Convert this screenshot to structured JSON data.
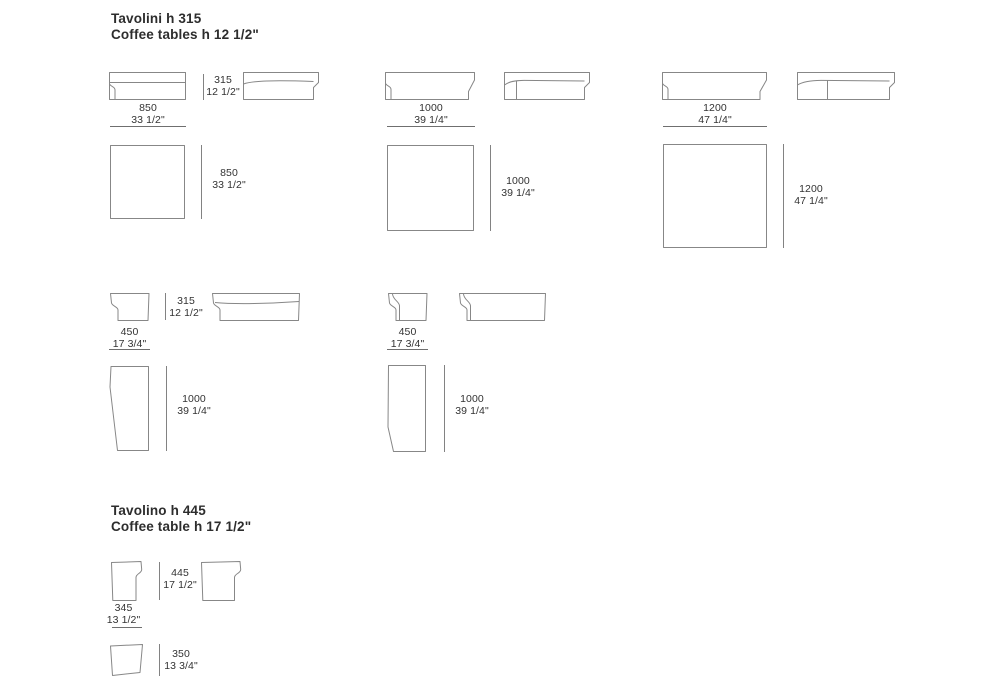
{
  "colors": {
    "line": "#878787",
    "text": "#333333",
    "heading": "#2d2d2d",
    "background": "#ffffff"
  },
  "section_tavolini": {
    "title_line1": "Tavolini h 315",
    "title_line2": "Coffee tables h 12 1/2\"",
    "height_mm": "315",
    "height_in": "12 1/2\"",
    "square_tables": [
      {
        "size_mm": "850",
        "size_in": "33 1/2\""
      },
      {
        "size_mm": "1000",
        "size_in": "39 1/4\""
      },
      {
        "size_mm": "1200",
        "size_in": "47 1/4\""
      }
    ],
    "rect_table": {
      "height_mm": "315",
      "height_in": "12 1/2\"",
      "width_mm": "450",
      "width_in": "17 3/4\"",
      "length_mm": "1000",
      "length_in": "39 1/4\""
    }
  },
  "section_tavolino": {
    "title_line1": "Tavolino h 445",
    "title_line2": "Coffee table h 17 1/2\"",
    "height_mm": "445",
    "height_in": "17 1/2\"",
    "width_mm": "345",
    "width_in": "13 1/2\"",
    "depth_mm": "350",
    "depth_in": "13 3/4\""
  }
}
